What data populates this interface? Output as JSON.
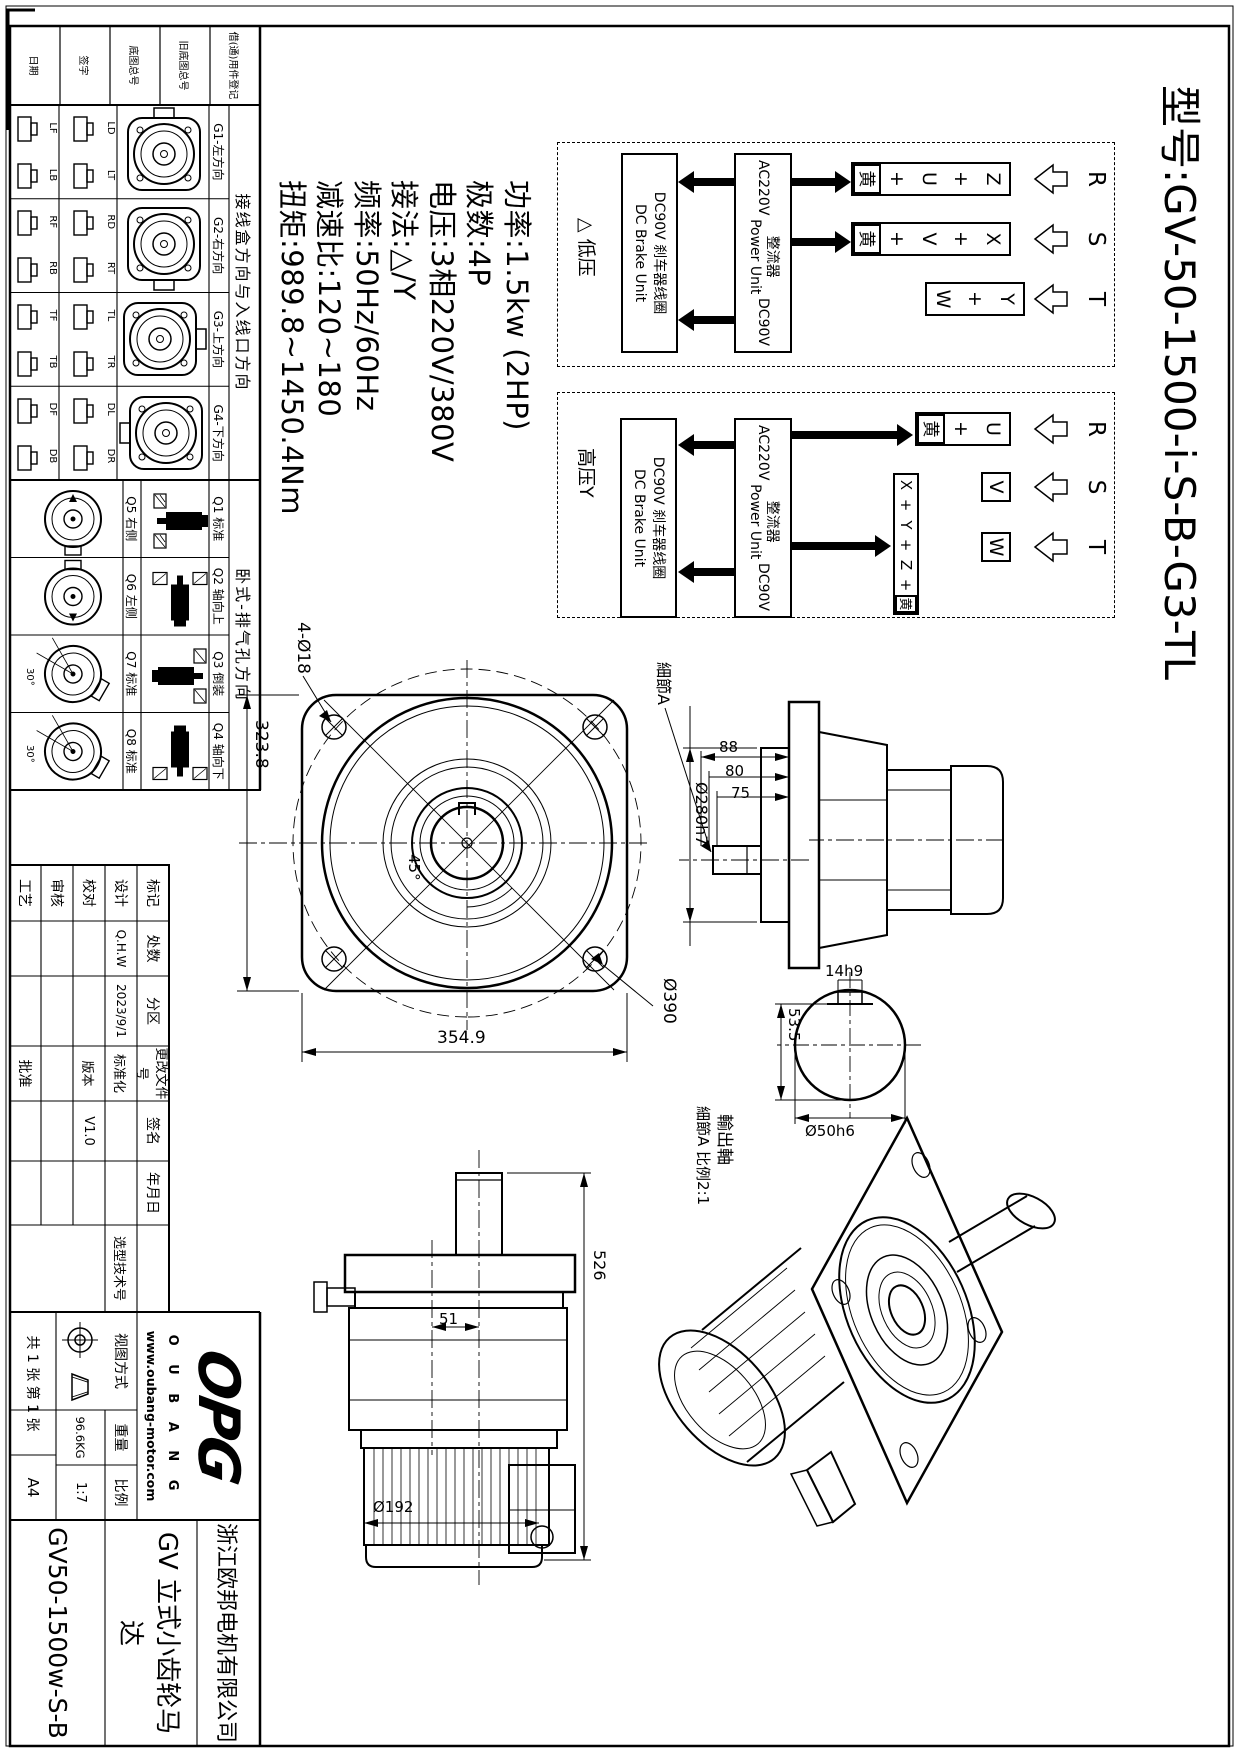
{
  "title": "型号:GV-50-1500-i-S-B-G3-TL",
  "specs": [
    "功率:1.5kw (2HP)",
    "极数:4P",
    "电压:3相220V/380V",
    "接法:△/Y",
    "频率:50Hz/60Hz",
    "减速比:120~180",
    "扭矩:989.8~1450.4Nm"
  ],
  "wiring": {
    "phases": [
      "R",
      "S",
      "T"
    ],
    "low": {
      "label": "△ 低压",
      "t1": [
        "Z",
        "+",
        "U",
        "+",
        "黄"
      ],
      "t2": [
        "X",
        "+",
        "V",
        "+",
        "黄"
      ],
      "t3": [
        "Y",
        "+",
        "W"
      ]
    },
    "high": {
      "label": "高压Y",
      "t1": [
        "U",
        "+",
        "黄"
      ],
      "t2": "V",
      "t3": "W",
      "strip": [
        "X",
        "+",
        "Y",
        "+",
        "Z",
        "+",
        "黄"
      ]
    },
    "rectifier": {
      "ac": "AC220V",
      "cn": "整流器",
      "en": "Power Unit",
      "dc": "DC90V"
    },
    "brake": {
      "cn": "DC90V 刹车器线圈",
      "en": "DC Brake Unit"
    }
  },
  "reg_rows": [
    "借(通)用件登记",
    "旧底图总号",
    "底图总号",
    "签字",
    "日期"
  ],
  "junction_table": {
    "header": "接线盒方向与入线口方向",
    "groups": [
      {
        "name": "G1-左方向",
        "a": "LD",
        "b": "LT",
        "c": "LF",
        "d": "LB"
      },
      {
        "name": "G2-右方向",
        "a": "RD",
        "b": "RT",
        "c": "RF",
        "d": "RB"
      },
      {
        "name": "G3-上方向",
        "a": "TL",
        "b": "TR",
        "c": "TF",
        "d": "TB"
      },
      {
        "name": "G4-下方向",
        "a": "DL",
        "b": "DR",
        "c": "DF",
        "d": "DB"
      }
    ]
  },
  "exhaust_table": {
    "header": "卧式-排气孔方向",
    "groups": [
      {
        "top": "Q1 标准",
        "bottom": "Q5 右侧"
      },
      {
        "top": "Q2 轴向上",
        "bottom": "Q6 左侧"
      },
      {
        "top": "Q3 倒装",
        "bottom": "Q7 标准",
        "angle": "30°"
      },
      {
        "top": "Q4 轴向下",
        "bottom": "Q8 标准",
        "angle": "30°"
      }
    ]
  },
  "titleblock": {
    "rev_header": [
      "标记",
      "处数",
      "分区",
      "更改文件号",
      "签名",
      "年月日"
    ],
    "rows": [
      [
        "设计",
        "Q.H.W",
        "2023/9/1",
        "标准化"
      ],
      [
        "校对",
        "",
        "",
        "版本"
      ],
      [
        "审核",
        "",
        "",
        ""
      ],
      [
        "工艺",
        "",
        "",
        "批准"
      ]
    ],
    "version": "V1.0",
    "sel_tech_no": "选型技术号",
    "view_mode": "视图方式",
    "weight_label": "重量",
    "weight": "96.6KG",
    "scale_label": "比例",
    "scale": "1:7",
    "sheet": "共 1 张 第 1 张",
    "paper": "A4",
    "company": "浙江欧邦电机有限公司",
    "product": "GV 立式小齿轮马达",
    "drawing_no": "GV50-1500w-S-B",
    "logo": {
      "main": "OPG",
      "sub": "O U B A N G",
      "site": "www.oubang-motor.com"
    }
  },
  "views": {
    "front": {
      "d1": "4-Ø18",
      "d2": "323.8",
      "d3": "354.9",
      "d4": "Ø390",
      "d5": "45°"
    },
    "side": {
      "d1": "88",
      "d2": "80",
      "d3": "75",
      "d4": "Ø280h7",
      "detail": "細節A"
    },
    "bottom": {
      "d1": "51",
      "d2": "526",
      "d3": "Ø192"
    },
    "detail": {
      "d1": "14h9",
      "d2": "53.5",
      "d3": "Ø50h6",
      "t1": "輸出軸",
      "t2": "細節A 比例2:1"
    }
  }
}
